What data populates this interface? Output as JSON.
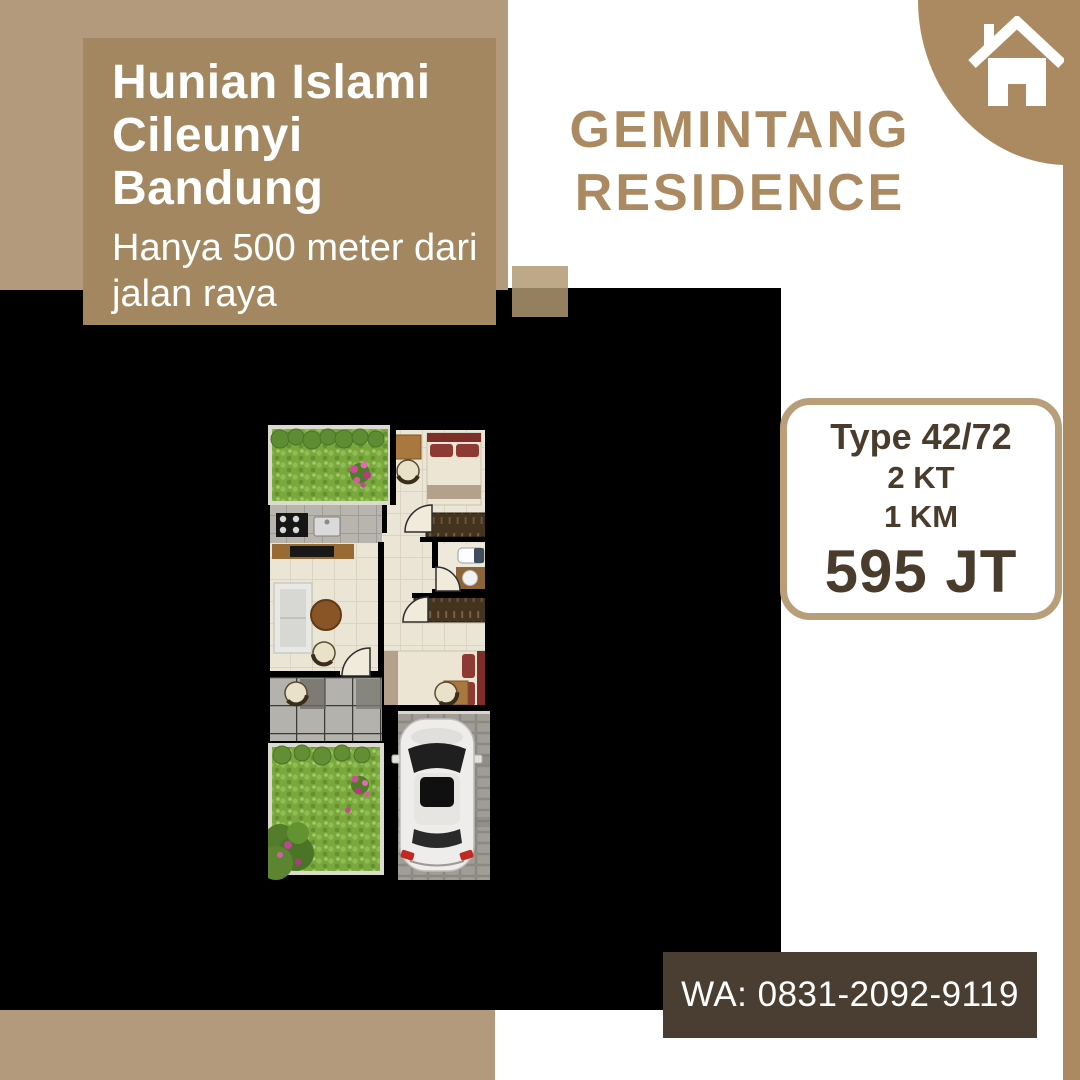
{
  "palette": {
    "tan_light": "#b39a7c",
    "tan_box": "#a28760",
    "tan_accent": "#ab8a62",
    "card_border": "#b89f79",
    "text_dark": "#4a3c2d",
    "cta_bg": "#4a3e33",
    "panel_black": "#000000"
  },
  "header": {
    "title_lines": [
      "Hunian Islami",
      "Cileunyi",
      "Bandung"
    ],
    "subtitle_lines": [
      "Hanya 500 meter dari",
      "jalan raya"
    ]
  },
  "brand": {
    "lines": [
      "GEMINTANG",
      "RESIDENCE"
    ],
    "icon": "house-icon"
  },
  "spec_card": {
    "type_label": "Type 42/72",
    "bedrooms": "2 KT",
    "bathrooms": "1 KM",
    "price": "595 JT"
  },
  "contact": {
    "whatsapp": "WA: 0831-2092-9119"
  },
  "floorplan": {
    "alt": "Top-view floor plan with two bedrooms, bathroom, kitchen, living room, back and front gardens, terrace and carport with car"
  }
}
